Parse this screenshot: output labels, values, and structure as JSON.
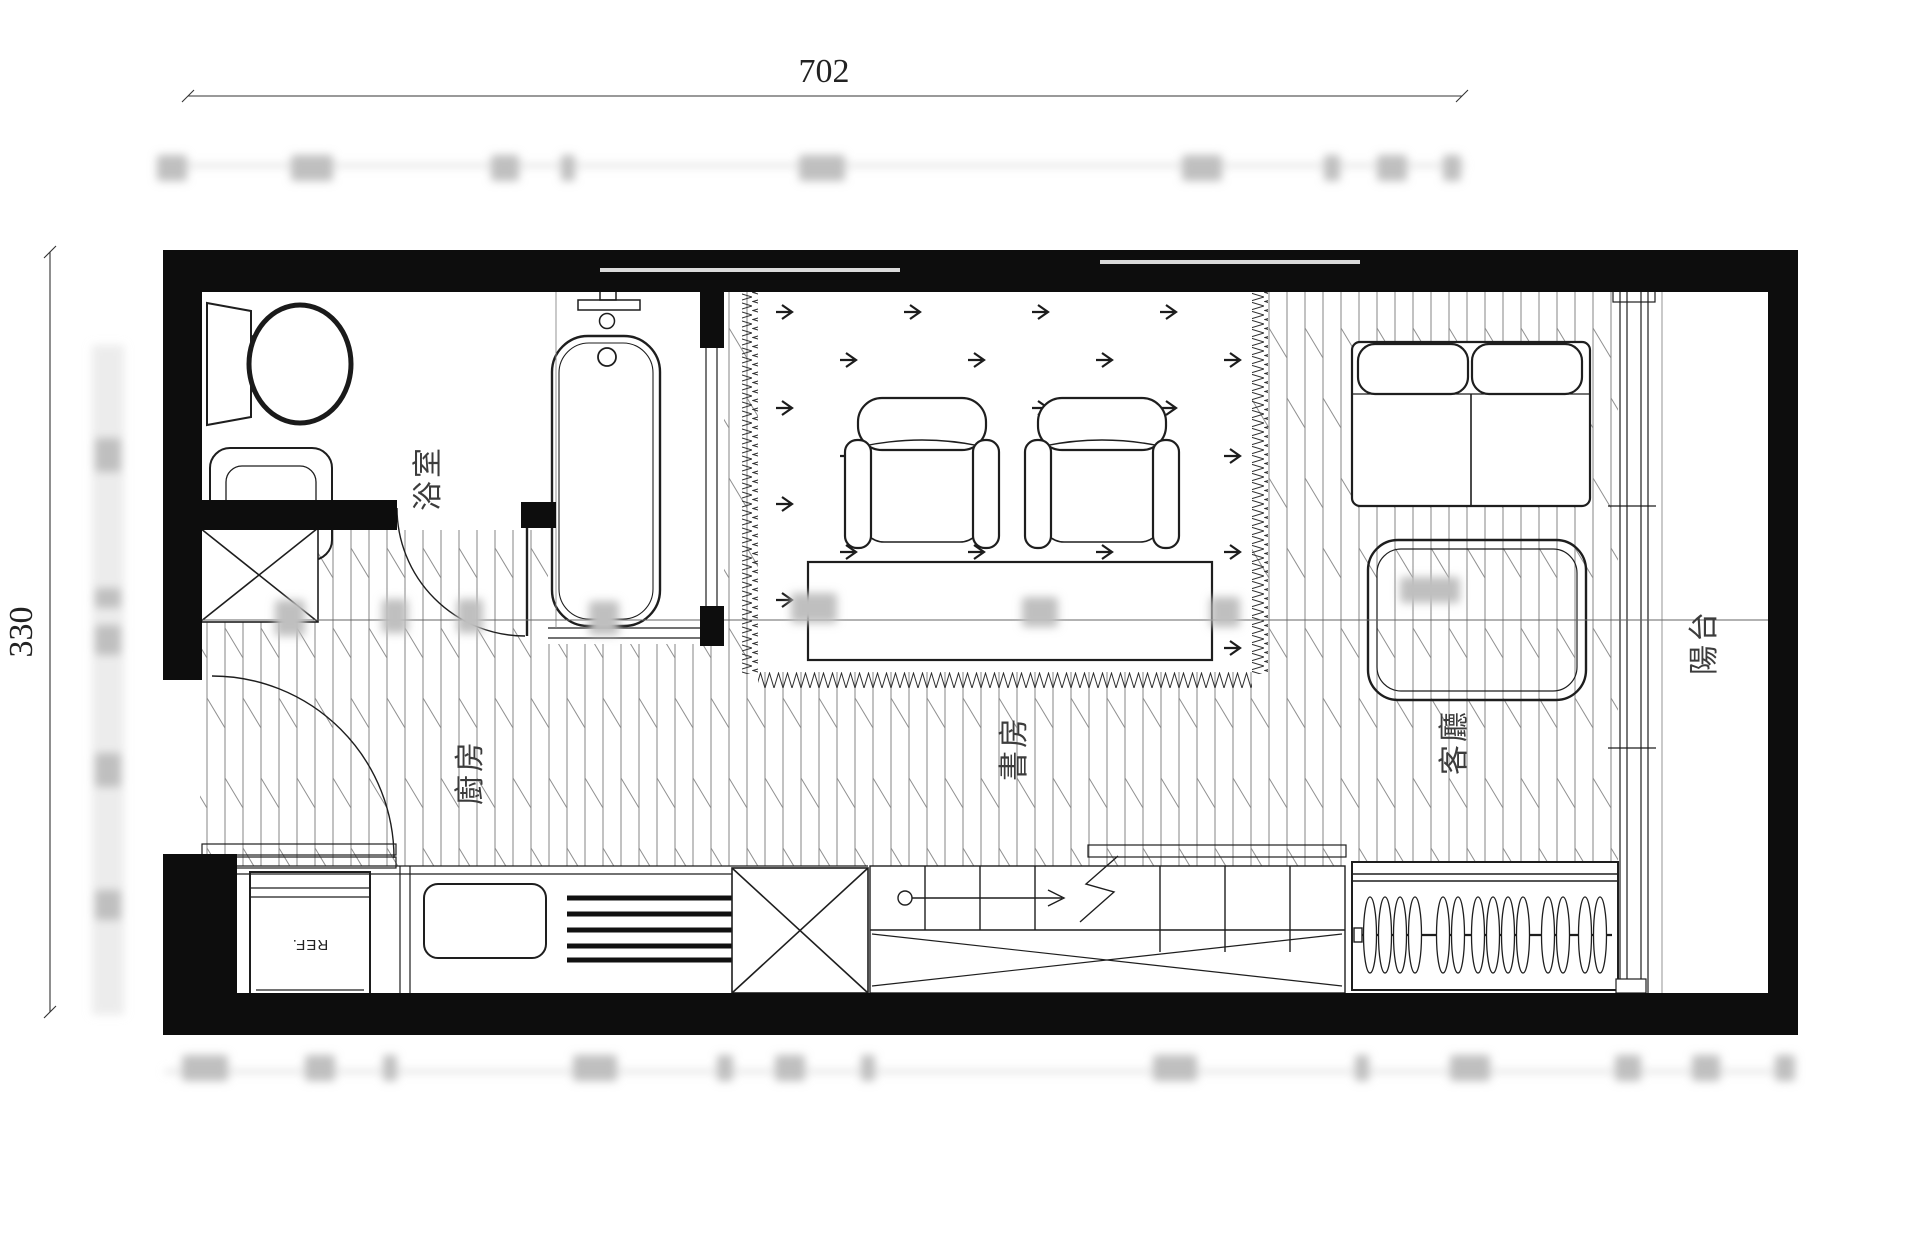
{
  "drawing": {
    "kind": "apartment-floor-plan",
    "dimensions": {
      "total_width": "702",
      "total_height": "330"
    },
    "rooms": {
      "bathroom": {
        "label": "浴室"
      },
      "kitchen": {
        "label": "廚房"
      },
      "study": {
        "label": "書房"
      },
      "living_room": {
        "label": "客廳"
      },
      "balcony": {
        "label": "陽台"
      }
    },
    "appliances": {
      "refrigerator_label": "REF."
    },
    "icons": [
      "toilet-icon",
      "sink-icon",
      "bathtub-icon",
      "armchair-icon",
      "desk-icon",
      "sofa-icon",
      "coffee-table-icon",
      "stove-icon",
      "vent-grill-icon",
      "stair-arrow-icon",
      "hanger-icon",
      "door-swing-icon",
      "sliding-door-icon"
    ]
  },
  "blurred_dimensions": {
    "top_row_y": 168,
    "top_row": [
      {
        "x": 172,
        "w": 30
      },
      {
        "x": 312,
        "w": 42
      },
      {
        "x": 505,
        "w": 28
      },
      {
        "x": 568,
        "w": 14
      },
      {
        "x": 822,
        "w": 46
      },
      {
        "x": 1202,
        "w": 40
      },
      {
        "x": 1332,
        "w": 16
      },
      {
        "x": 1392,
        "w": 30
      },
      {
        "x": 1452,
        "w": 18
      }
    ],
    "left_column_x": 108,
    "left_column": [
      {
        "y": 455,
        "h": 34
      },
      {
        "y": 598,
        "h": 20
      },
      {
        "y": 640,
        "h": 30
      },
      {
        "y": 770,
        "h": 34
      },
      {
        "y": 905,
        "h": 30
      }
    ],
    "bottom_row_y": 1068,
    "bottom_row": [
      {
        "x": 205,
        "w": 46
      },
      {
        "x": 320,
        "w": 30
      },
      {
        "x": 390,
        "w": 14
      },
      {
        "x": 595,
        "w": 44
      },
      {
        "x": 725,
        "w": 16
      },
      {
        "x": 790,
        "w": 30
      },
      {
        "x": 868,
        "w": 14
      },
      {
        "x": 1175,
        "w": 44
      },
      {
        "x": 1362,
        "w": 14
      },
      {
        "x": 1470,
        "w": 40
      },
      {
        "x": 1628,
        "w": 26
      },
      {
        "x": 1706,
        "w": 28
      },
      {
        "x": 1785,
        "w": 20
      }
    ],
    "interior": [
      {
        "x": 290,
        "y": 618,
        "w": 30,
        "h": 36
      },
      {
        "x": 395,
        "y": 616,
        "w": 26,
        "h": 34
      },
      {
        "x": 470,
        "y": 616,
        "w": 26,
        "h": 34
      },
      {
        "x": 604,
        "y": 618,
        "w": 30,
        "h": 34
      },
      {
        "x": 814,
        "y": 608,
        "w": 46,
        "h": 30
      },
      {
        "x": 1040,
        "y": 612,
        "w": 36,
        "h": 30
      },
      {
        "x": 1225,
        "y": 612,
        "w": 30,
        "h": 30
      },
      {
        "x": 1430,
        "y": 590,
        "w": 60,
        "h": 26
      }
    ]
  },
  "colors": {
    "wall": "#0d0d0d",
    "line": "#1e1e1e",
    "hatch": "#8f8f8f",
    "blur": "#bfbfbf",
    "label": "#3c3c3c"
  }
}
